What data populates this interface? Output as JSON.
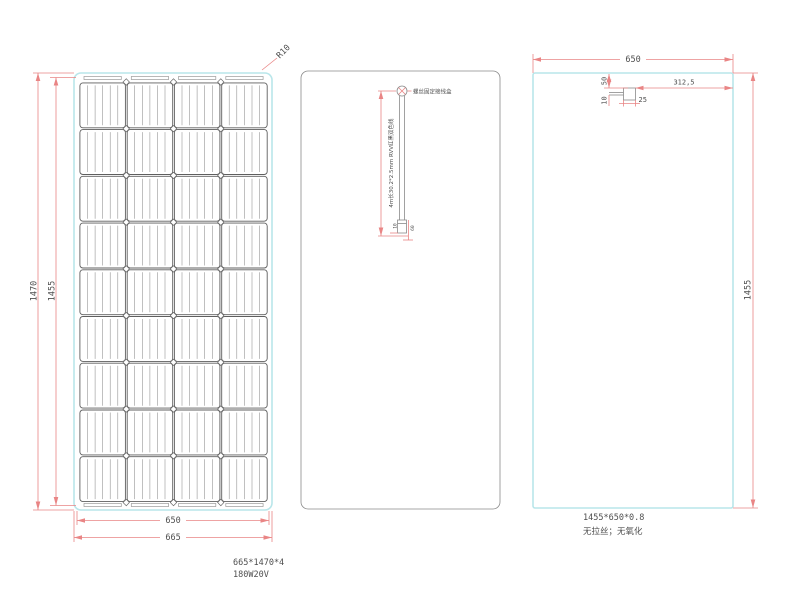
{
  "front_view": {
    "dim_height_outer": "1470",
    "dim_height_inner": "1455",
    "dim_width_inner": "650",
    "dim_width_outer": "665",
    "corner_radius": "R10",
    "grid": {
      "rows": 9,
      "cols": 4,
      "busbars_per_cell": 5
    }
  },
  "back_view": {
    "junction_label": "螺丝固定接线盒",
    "cable_label": "4m长30.2*2.5mm RVV红黑双色线",
    "cable_dim_a": "10",
    "cable_dim_b": "60"
  },
  "side_view": {
    "dim_width": "650",
    "dim_height": "1455",
    "dim_box_offset_top": "50",
    "dim_box_offset_side": "10",
    "dim_box_width": "25",
    "dim_box_to_edge": "312,5",
    "note_size": "1455*650*0.8",
    "note_finish": "无拉丝；无氧化"
  },
  "footer": {
    "panel_size": "665*1470*4",
    "power_spec": "180W20V"
  },
  "colors": {
    "dimension_red": "#e98585",
    "outline_cyan": "#b9e6ea",
    "text_gray": "#4f4f4f"
  }
}
